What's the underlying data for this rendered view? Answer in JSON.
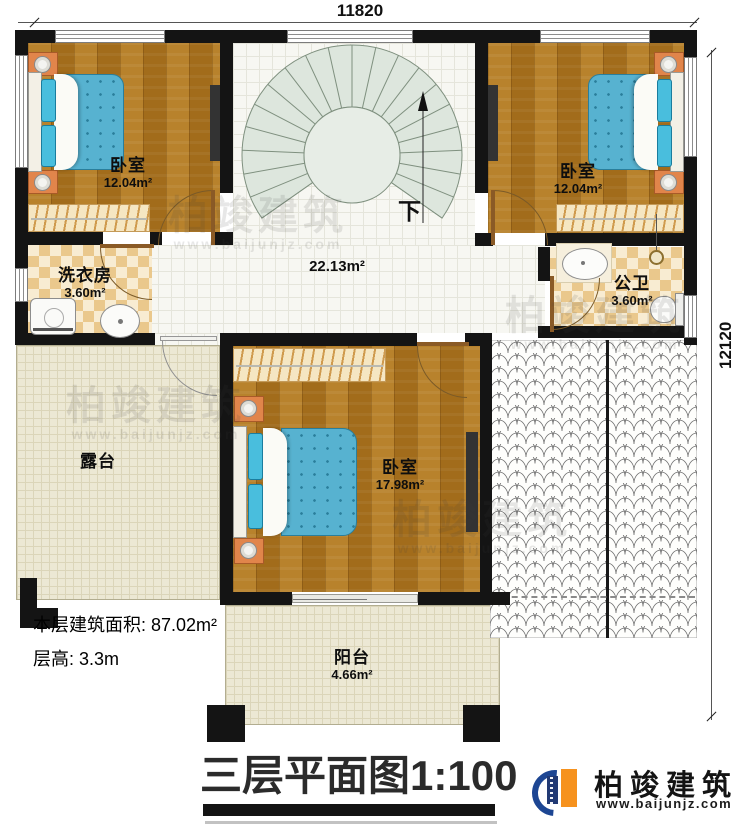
{
  "title": {
    "name": "三层平面图",
    "scale": "1:100"
  },
  "dimensions": {
    "width": "11820",
    "height": "12120"
  },
  "notes": {
    "floor_area": "本层建筑面积: 87.02m²",
    "floor_height": "层高: 3.3m"
  },
  "rooms": {
    "bedroom_tl": {
      "name": "卧室",
      "area": "12.04m²"
    },
    "bedroom_tr": {
      "name": "卧室",
      "area": "12.04m²"
    },
    "laundry": {
      "name": "洗衣房",
      "area": "3.60m²"
    },
    "bathroom": {
      "name": "公卫",
      "area": "3.60m²"
    },
    "bedroom_main": {
      "name": "卧室",
      "area": "17.98m²"
    },
    "terrace": {
      "name": "露台"
    },
    "balcony": {
      "name": "阳台",
      "area": "4.66m²"
    },
    "hall": {
      "area": "22.13m²"
    }
  },
  "stairs": {
    "direction_label": "下"
  },
  "brand": {
    "name": "柏竣建筑",
    "website": "www.baijunjz.com"
  },
  "watermark": {
    "name": "柏竣建筑",
    "website": "www.baijunjz.com"
  },
  "colors": {
    "wall": "#141414",
    "wood": "#b0771f",
    "bed_blue": "#57b2d0",
    "brand_blue": "#1d4693",
    "brand_orange": "#f6921e"
  }
}
